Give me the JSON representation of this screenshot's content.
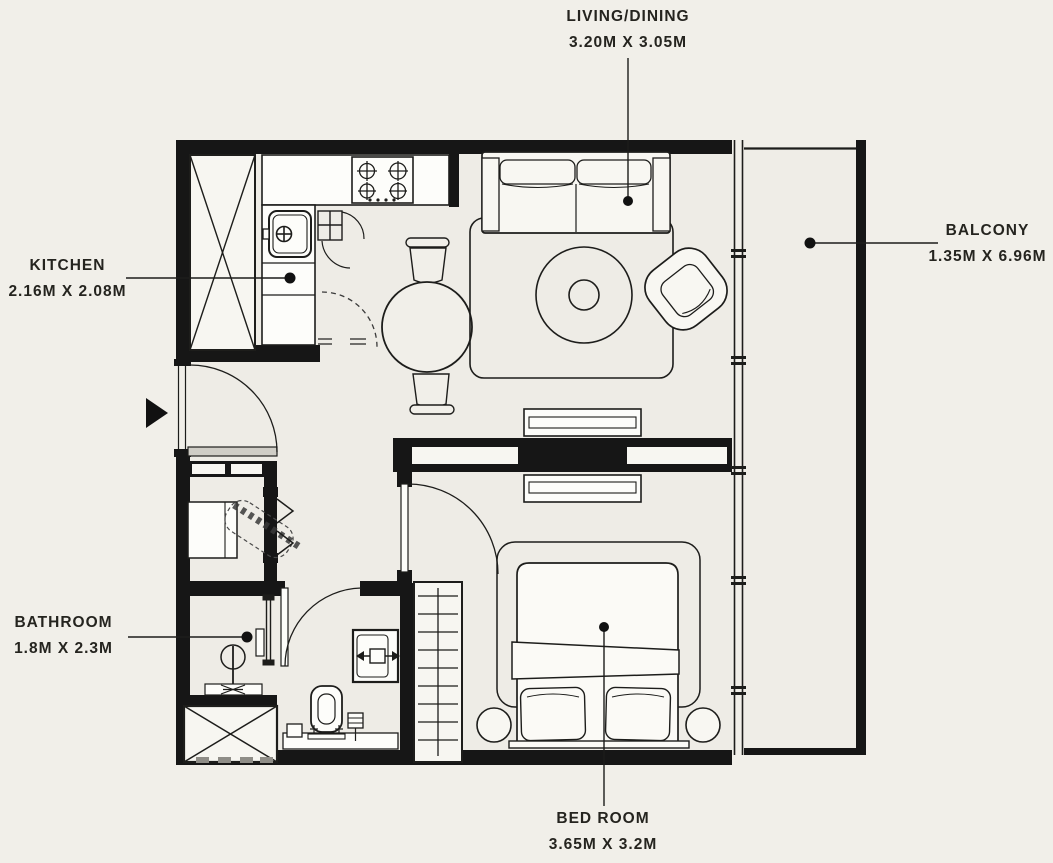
{
  "colors": {
    "background": "#f1efe9",
    "wall": "#161616",
    "ink": "#1d1d1b",
    "fixture_fill": "#fdfdfa"
  },
  "floor_plan": {
    "type": "apartment-floor-plan",
    "rooms": [
      {
        "key": "living-dining",
        "name": "LIVING/DINING",
        "dimensions": "3.20M X 3.05M",
        "label_position": "top"
      },
      {
        "key": "kitchen",
        "name": "KITCHEN",
        "dimensions": "2.16M X 2.08M",
        "label_position": "left"
      },
      {
        "key": "balcony",
        "name": "BALCONY",
        "dimensions": "1.35M X 6.96M",
        "label_position": "right"
      },
      {
        "key": "bathroom",
        "name": "BATHROOM",
        "dimensions": "1.8M X 2.3M",
        "label_position": "left"
      },
      {
        "key": "bed-room",
        "name": "BED ROOM",
        "dimensions": "3.65M X 3.2M",
        "label_position": "bottom"
      }
    ],
    "fixtures": [
      "entrance-arrow",
      "entry-door",
      "service-shaft",
      "kitchen-counter",
      "stove-4-burner",
      "kitchen-sink",
      "dining-table-with-chairs",
      "sofa-2-seat",
      "area-rug",
      "armchair",
      "tv-console",
      "double-bed",
      "nightstands",
      "wardrobe",
      "utility-closet",
      "bifold-door",
      "shower",
      "toilet",
      "washbasin",
      "balcony-glazing"
    ]
  }
}
